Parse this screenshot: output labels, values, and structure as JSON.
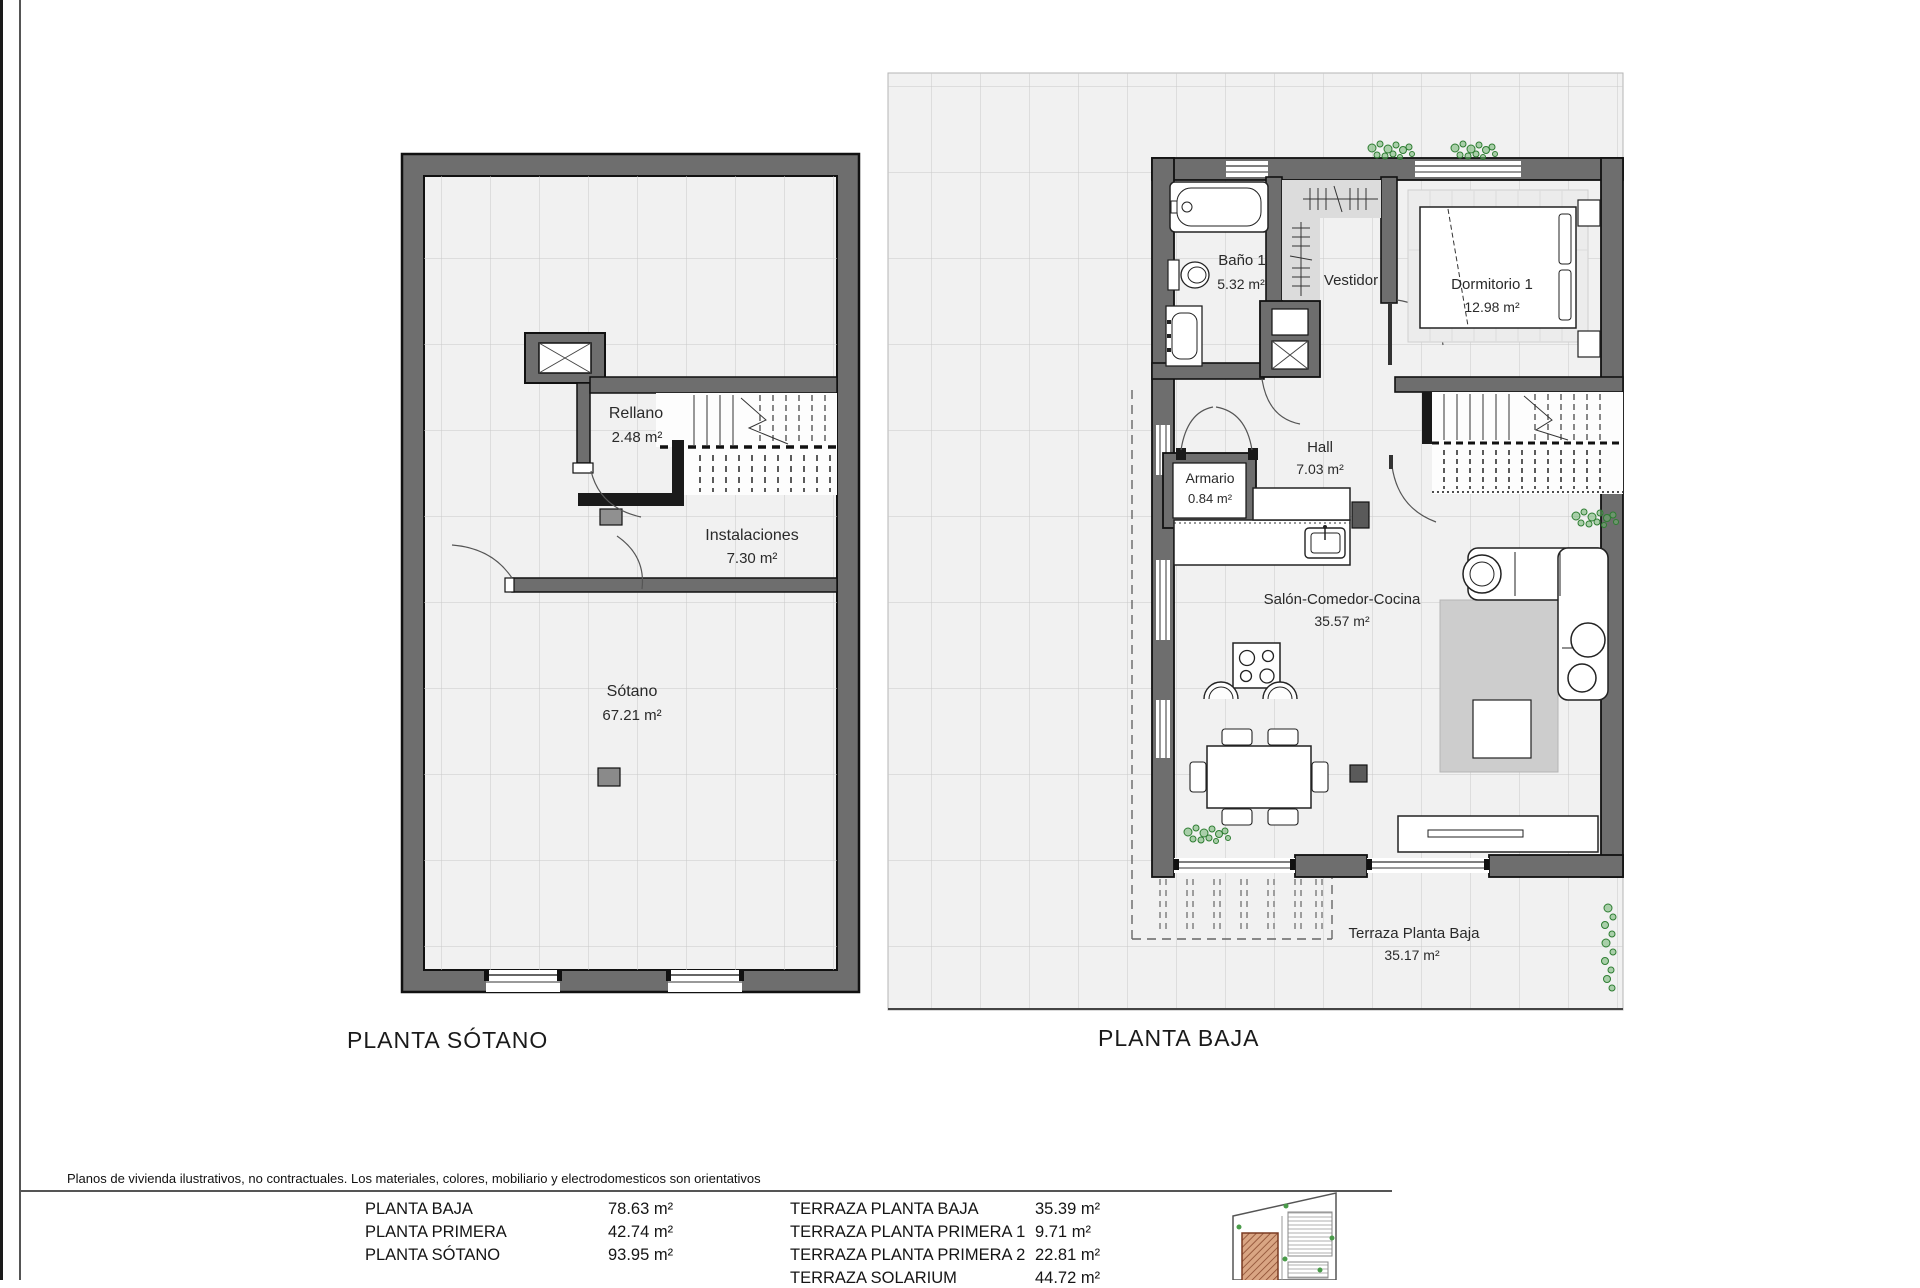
{
  "sheet": {
    "disclaimer": "Planos de vivienda ilustrativos, no contractuales. Los materiales, colores, mobiliario y electrodomesticos son orientativos"
  },
  "plans": {
    "sotano": {
      "title": "PLANTA SÓTANO",
      "rooms": [
        {
          "name": "Rellano",
          "area": "2.48 m²"
        },
        {
          "name": "Instalaciones",
          "area": "7.30 m²"
        },
        {
          "name": "Sótano",
          "area": "67.21 m²"
        }
      ]
    },
    "baja": {
      "title": "PLANTA BAJA",
      "rooms": [
        {
          "name": "Baño 1",
          "area": "5.32 m²"
        },
        {
          "name": "Vestidor",
          "area": ""
        },
        {
          "name": "Dormitorio 1",
          "area": "12.98 m²"
        },
        {
          "name": "Hall",
          "area": "7.03 m²"
        },
        {
          "name": "Armario",
          "area": "0.84 m²"
        },
        {
          "name": "Salón-Comedor-Cocina",
          "area": "35.57 m²"
        },
        {
          "name": "Terraza Planta Baja",
          "area": "35.17 m²"
        }
      ]
    }
  },
  "legend": {
    "left": [
      {
        "label": "PLANTA BAJA",
        "value": "78.63 m²"
      },
      {
        "label": "PLANTA PRIMERA",
        "value": "42.74 m²"
      },
      {
        "label": "PLANTA SÓTANO",
        "value": "93.95 m²"
      }
    ],
    "right": [
      {
        "label": "TERRAZA PLANTA BAJA",
        "value": "35.39 m²"
      },
      {
        "label": "TERRAZA PLANTA PRIMERA 1",
        "value": "9.71 m²"
      },
      {
        "label": "TERRAZA PLANTA PRIMERA 2",
        "value": "22.81 m²"
      },
      {
        "label": "TERRAZA SOLARIUM",
        "value": "44.72 m²"
      }
    ]
  },
  "colors": {
    "wall_gray": "#6e6e6e",
    "wall_black": "#1a1a1a",
    "floor": "#f1f1f1",
    "grid_line": "#c9c9c9",
    "vestidor_fill": "#dcdcdc",
    "rug": "#cdcdcd",
    "plant_green": "#2e7d32",
    "thumbnail_brown": "#c98f6f"
  }
}
